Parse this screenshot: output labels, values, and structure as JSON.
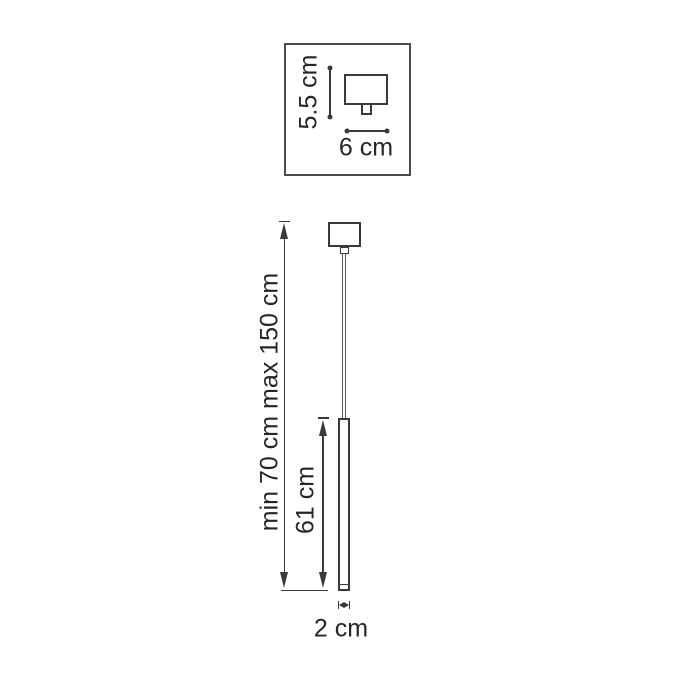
{
  "diagram": {
    "inset": {
      "height_label": "5.5 cm",
      "width_label": "6 cm"
    },
    "pendant": {
      "suspension_range_label": "min 70 cm max 150 cm",
      "body_length_label": "61 cm",
      "body_diameter_label": "2 cm"
    },
    "colors": {
      "line": "#3a3a3a",
      "text": "#262626",
      "background": "#ffffff"
    }
  }
}
